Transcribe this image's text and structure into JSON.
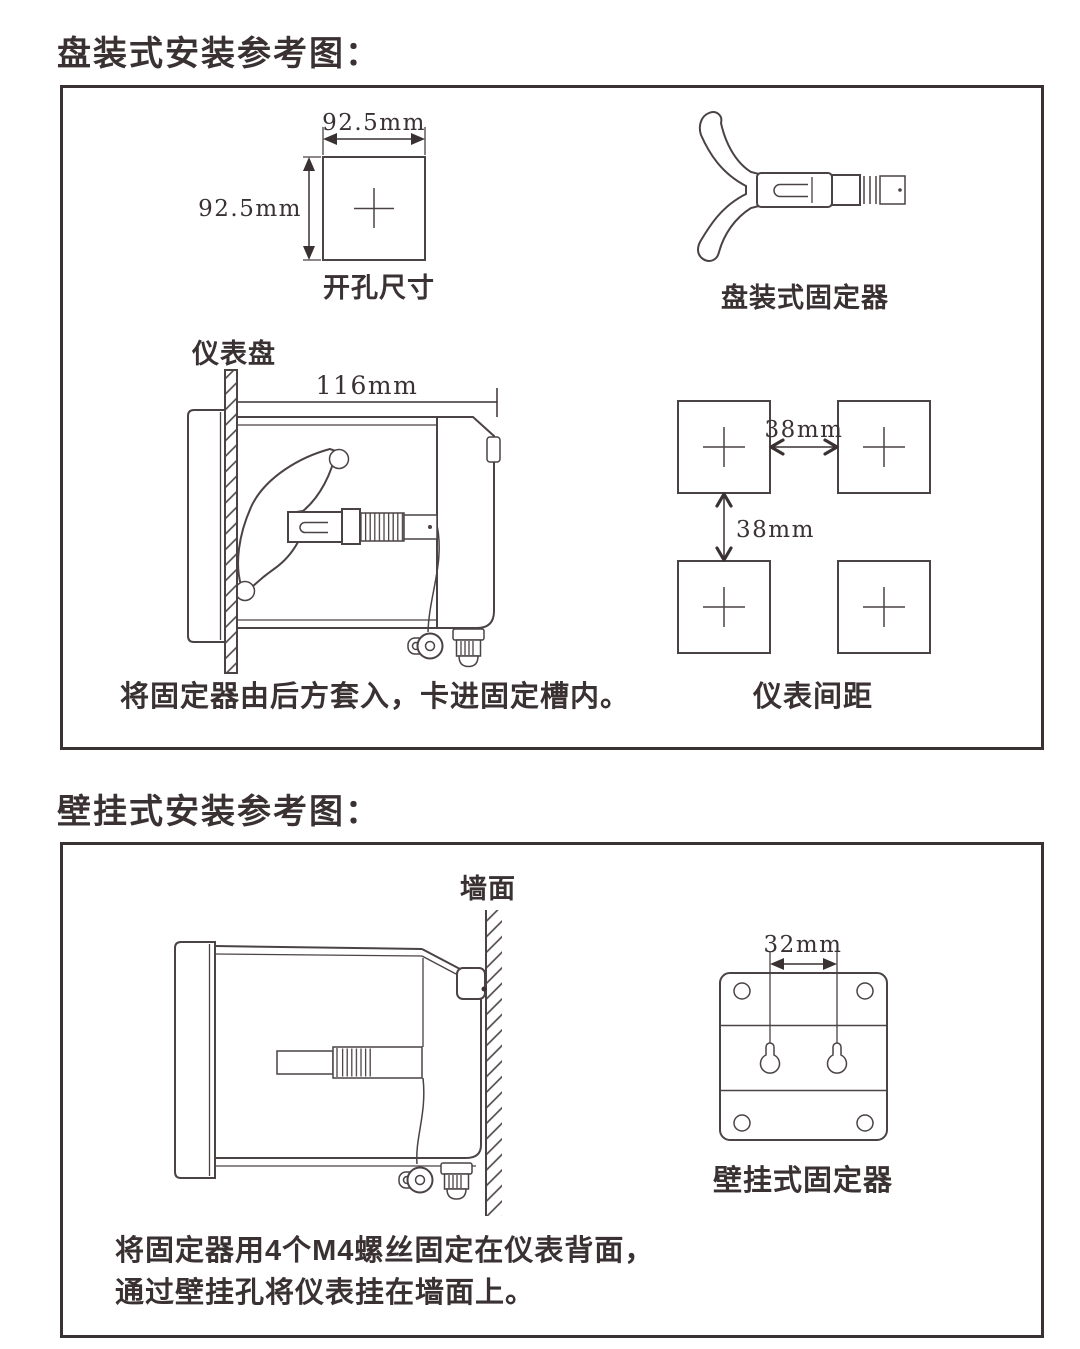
{
  "colors": {
    "ink": "#3a3133",
    "line": "#4b4244",
    "background": "#ffffff"
  },
  "panel_section": {
    "title": "盘装式安装参考图：",
    "cutout": {
      "width_dim": "92.5mm",
      "height_dim": "92.5mm",
      "caption": "开孔尺寸"
    },
    "fixer": {
      "caption": "盘装式固定器"
    },
    "side_view": {
      "panel_label": "仪表盘",
      "depth_dim": "116mm",
      "caption": "将固定器由后方套入，卡进固定槽内。"
    },
    "spacing": {
      "h_dim": "38mm",
      "v_dim": "38mm",
      "caption": "仪表间距"
    }
  },
  "wall_section": {
    "title": "壁挂式安装参考图：",
    "side_view": {
      "wall_label": "墙面",
      "caption_line1": "将固定器用4个M4螺丝固定在仪表背面，",
      "caption_line2": "通过壁挂孔将仪表挂在墙面上。"
    },
    "bracket": {
      "hole_dim": "32mm",
      "caption": "壁挂式固定器"
    }
  }
}
